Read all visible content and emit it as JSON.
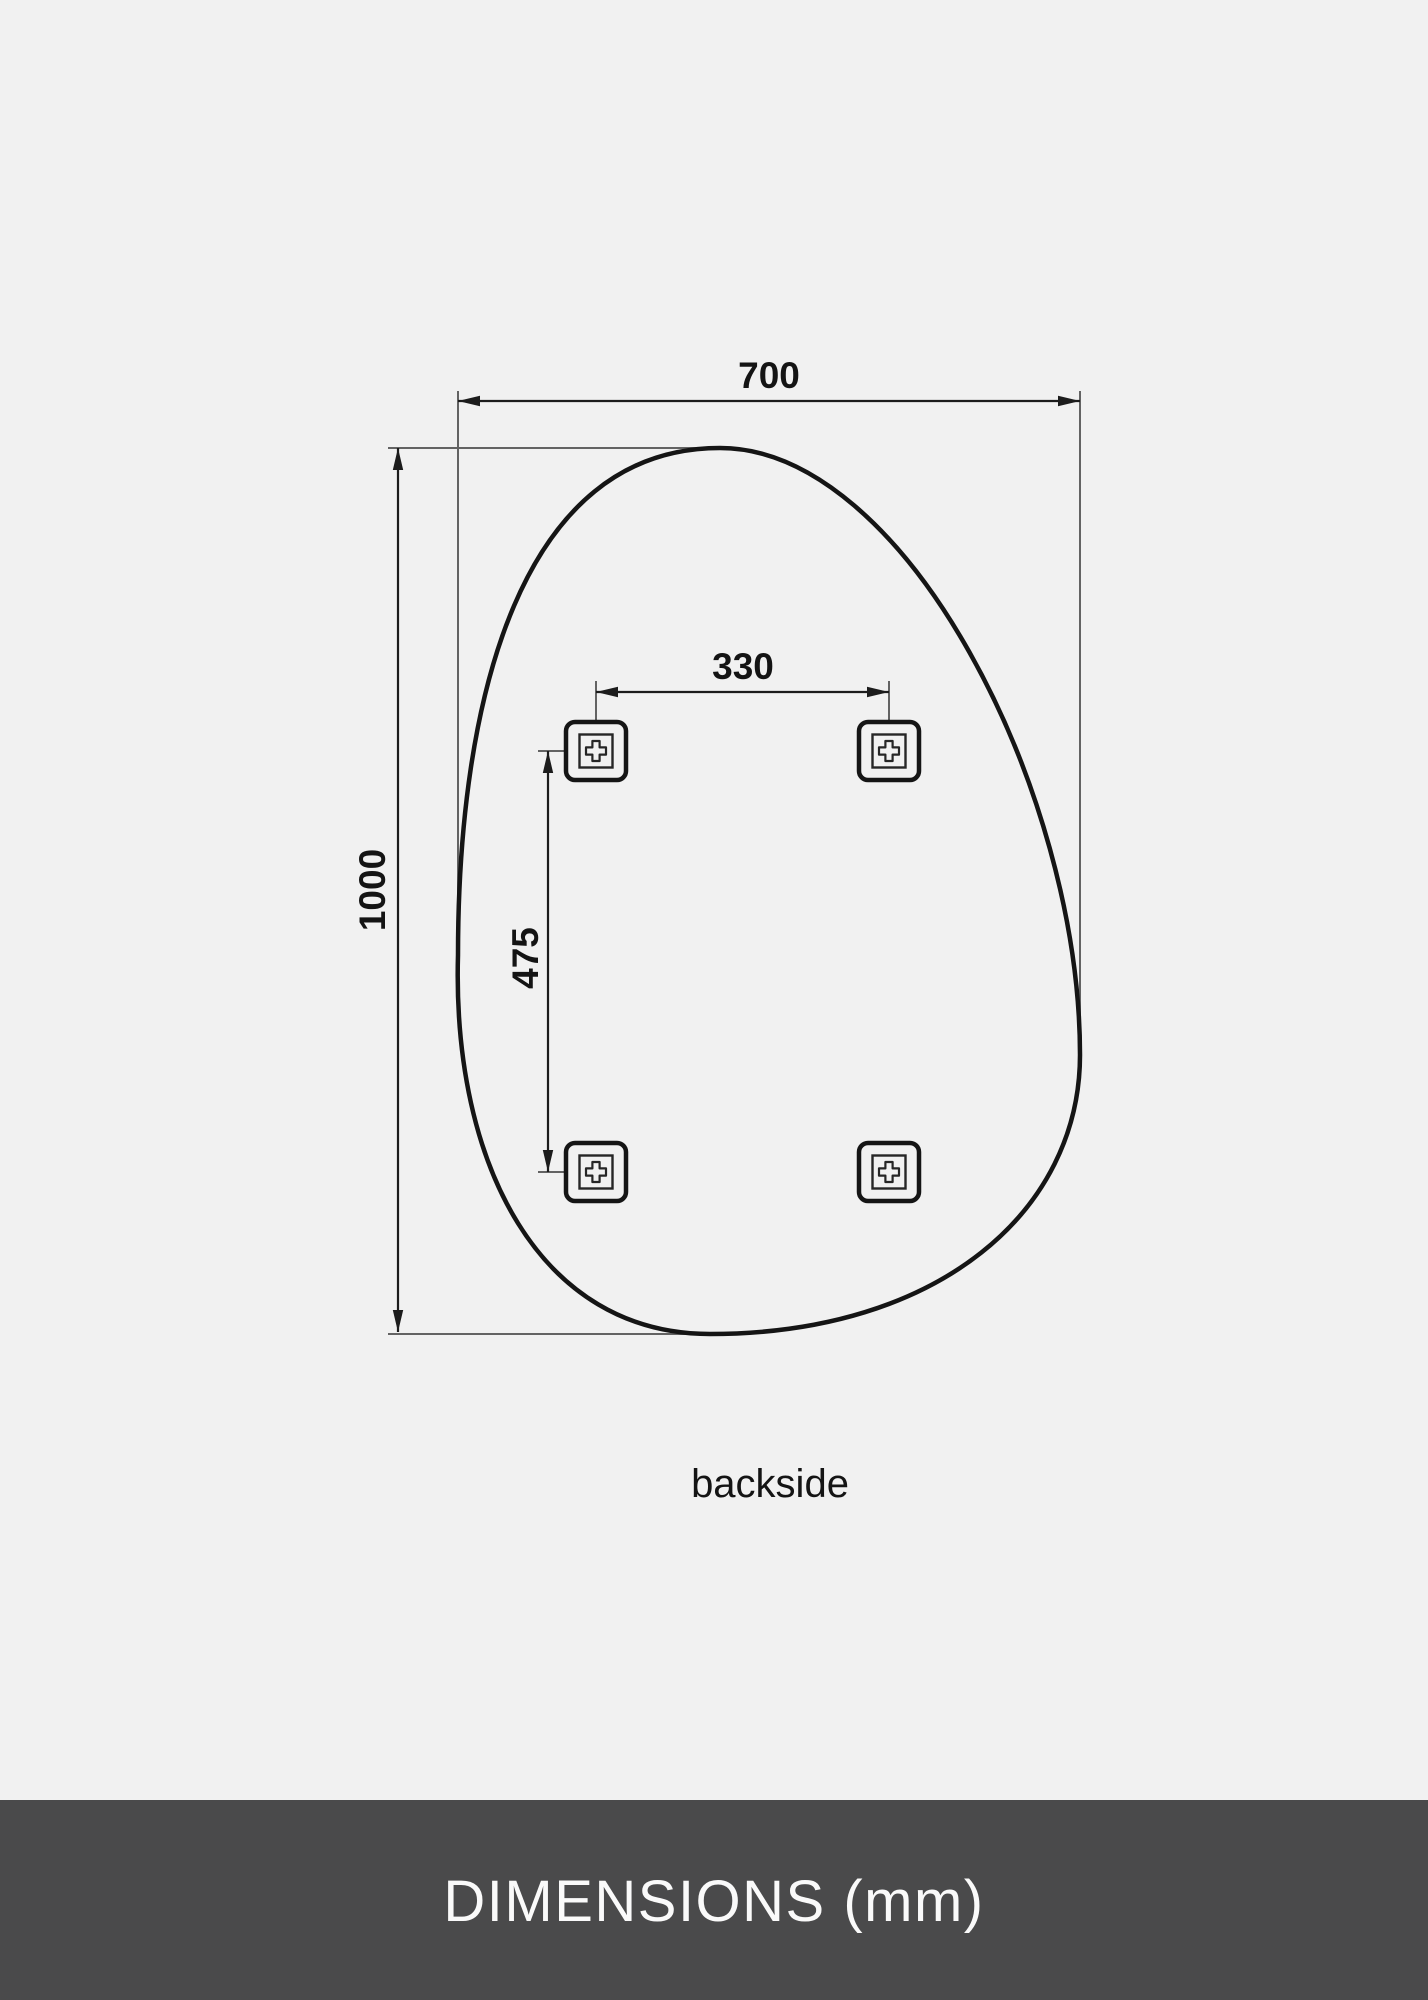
{
  "page": {
    "background_color": "#f1f1f1"
  },
  "diagram": {
    "caption": "backside",
    "unit": "mm",
    "labels": {
      "width": "700",
      "height": "1000",
      "hole_spacing_horizontal": "330",
      "hole_spacing_vertical": "475"
    },
    "mounting_brackets_count": 4
  },
  "footer": {
    "title": "DIMENSIONS (mm)",
    "background_color": "#4a4a4b",
    "text_color": "#fafafa"
  },
  "colors": {
    "outline": "#151515",
    "dimension_line": "#1c1c1c",
    "extension_line": "#636363",
    "label_text": "#141414"
  }
}
